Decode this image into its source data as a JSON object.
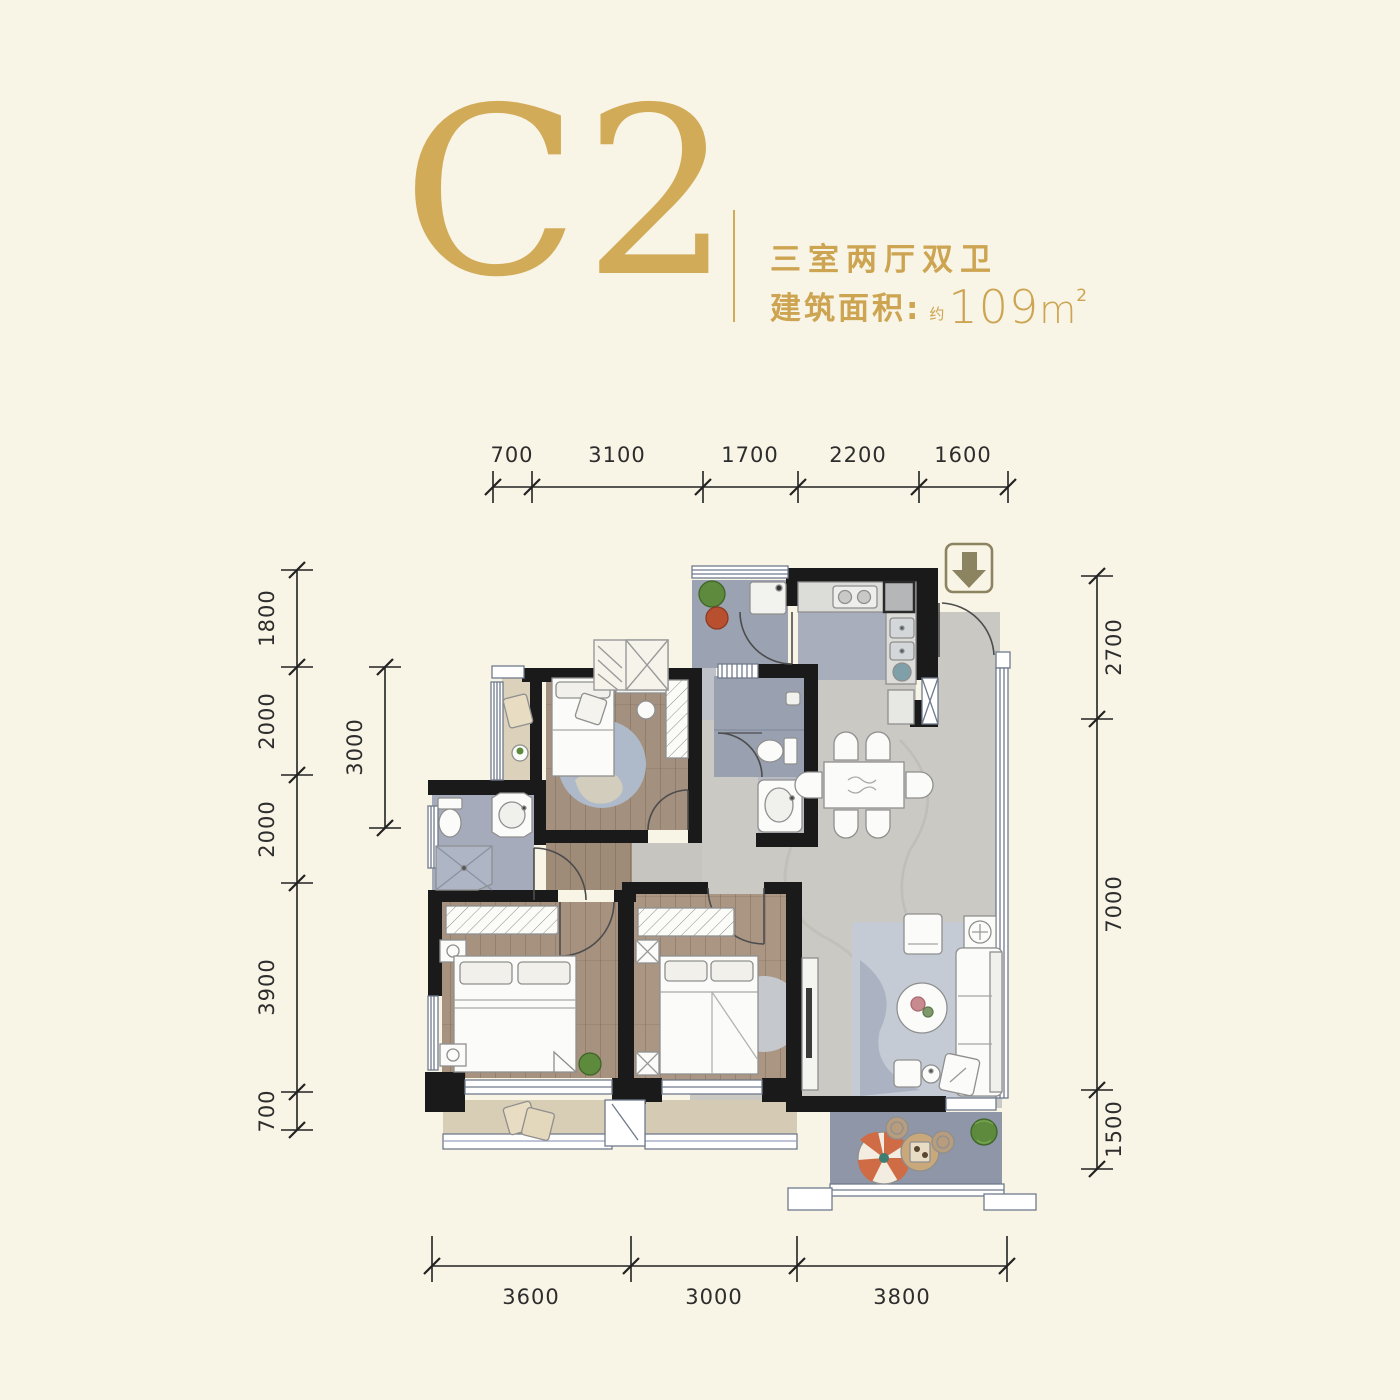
{
  "header": {
    "unit_code": "C2",
    "unit_type": "三室两厅双卫",
    "area_label": "建筑面积:",
    "area_approx": "约",
    "area_value": "109",
    "area_unit": "m",
    "area_exponent": "2"
  },
  "dimensions": {
    "top": [
      "700",
      "3100",
      "1700",
      "2200",
      "1600"
    ],
    "left": [
      "1800",
      "2000",
      "2000",
      "3900",
      "700"
    ],
    "left_inner": [
      "3000"
    ],
    "right": [
      "2700",
      "7000",
      "1500"
    ],
    "bottom": [
      "3600",
      "3000",
      "3800"
    ]
  },
  "colors": {
    "background": "#f8f4e6",
    "gold": "#d2ab58",
    "wall": "#1a1a1a",
    "wood_floor": "#a3907f",
    "tile_floor": "#9aa2b2",
    "marble_floor": "#cac9c4",
    "balcony_floor": "#d8cdb5",
    "parasol_accent": "#cf6b45",
    "plant_green": "#5d8a3c",
    "entry_arrow": "#8c8460"
  }
}
